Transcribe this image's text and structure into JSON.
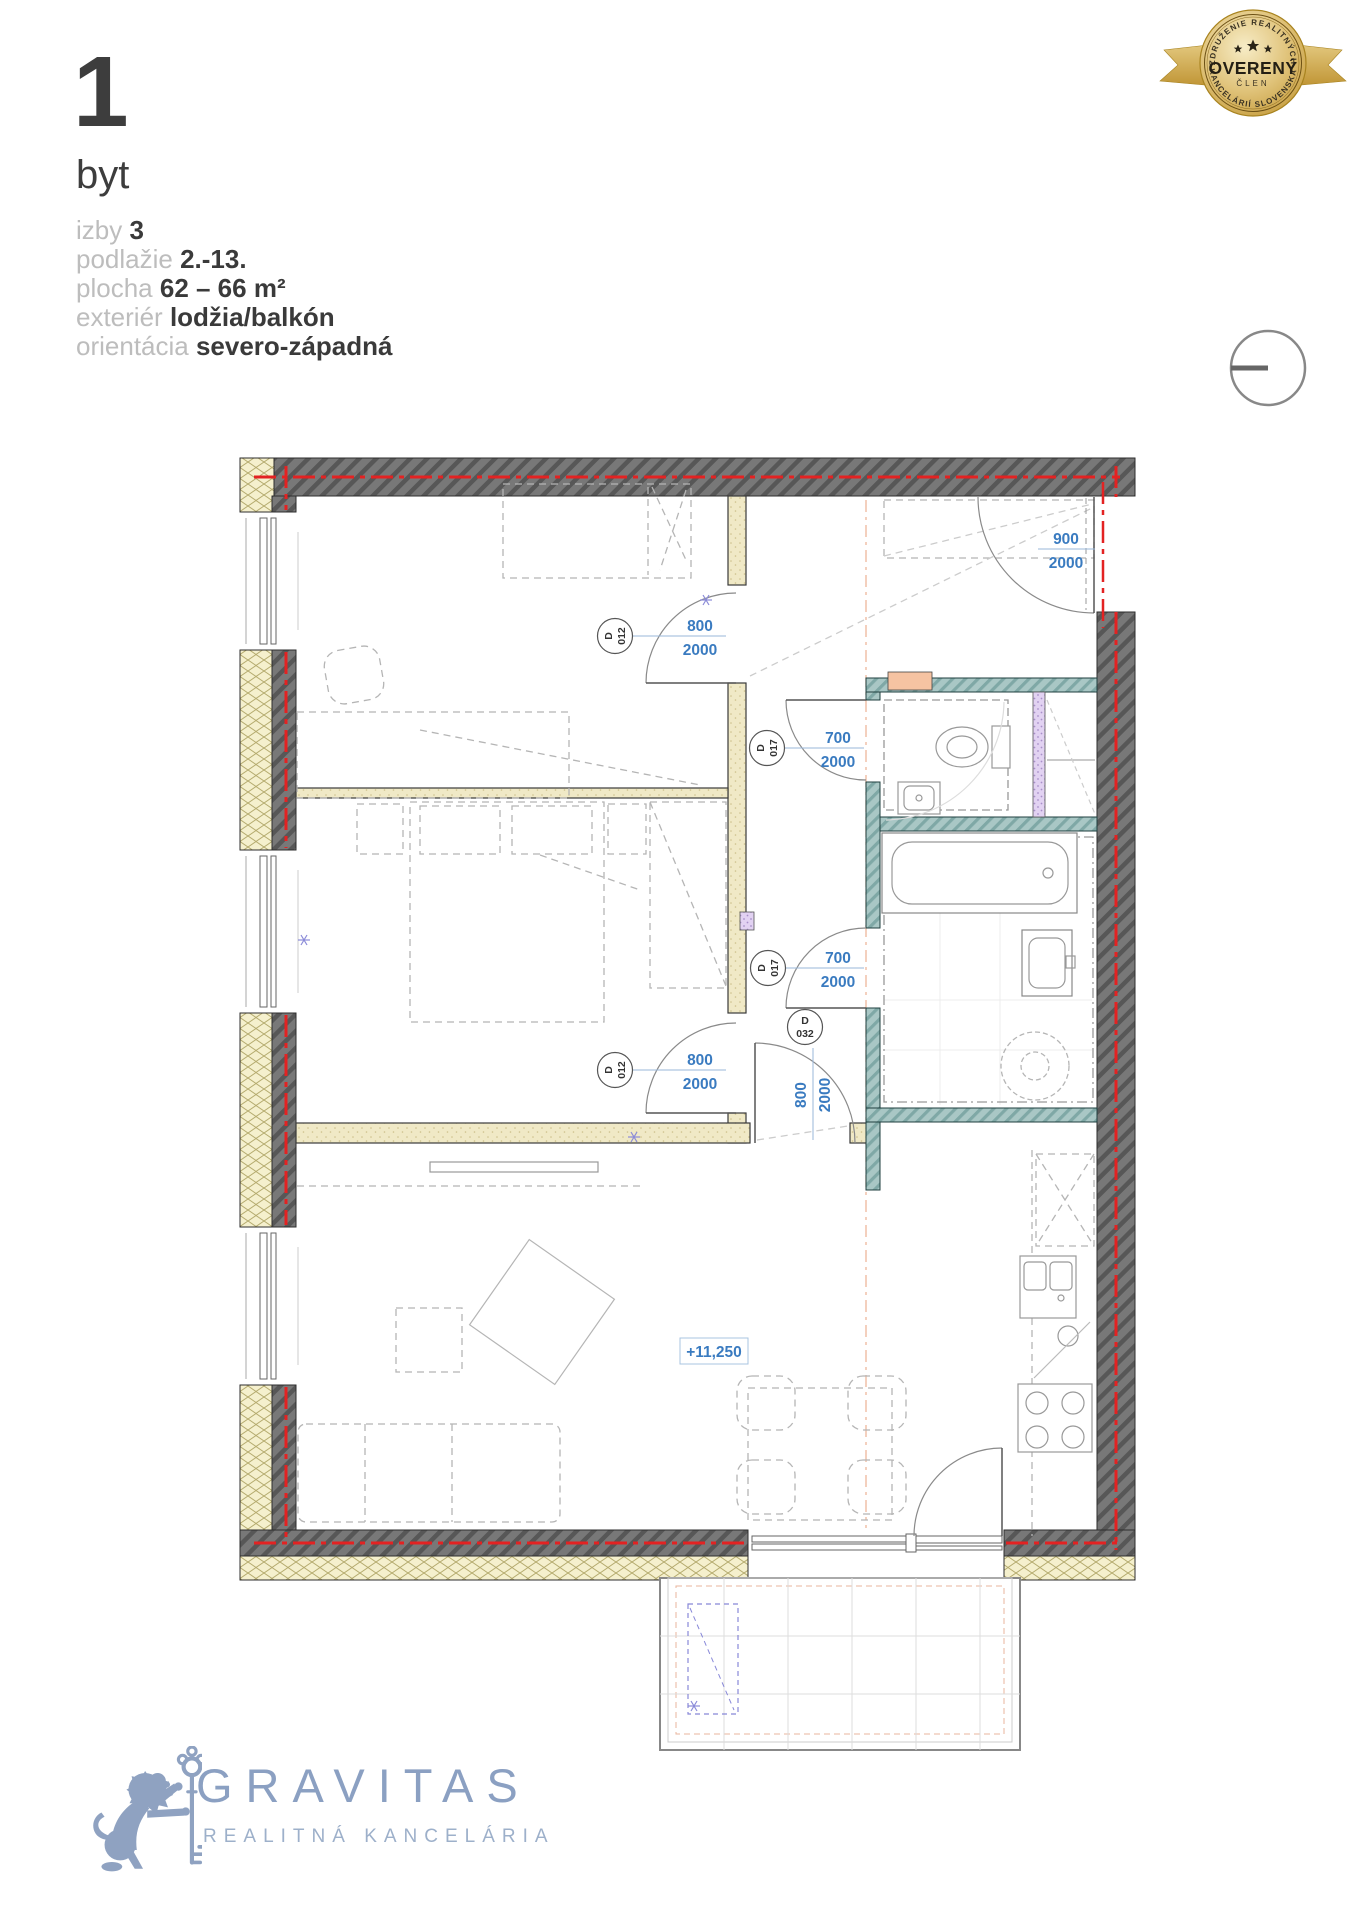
{
  "unit": {
    "number": "1",
    "type": "byt",
    "details": [
      {
        "label": "izby",
        "value": "3"
      },
      {
        "label": "podlažie",
        "value": "2.-13."
      },
      {
        "label": "plocha",
        "value": "62 – 66 m²"
      },
      {
        "label": "exteriér",
        "value": "lodžia/balkón"
      },
      {
        "label": "orientácia",
        "value": "severo-západná"
      }
    ]
  },
  "badge": {
    "top_arc": "ZDRUŽENIE REALITNÝCH",
    "title": "OVERENÝ",
    "member": "ČLEN",
    "bottom_arc": "KANCELÁRIÍ SLOVENSKA"
  },
  "floorplan": {
    "level_label": "+11,250",
    "door_labels": [
      {
        "code": "D",
        "num": "012",
        "w": "800",
        "h": "2000"
      },
      {
        "code": "D",
        "num": "012",
        "w": "800",
        "h": "2000"
      },
      {
        "code": "D",
        "num": "017",
        "w": "700",
        "h": "2000"
      },
      {
        "code": "D",
        "num": "017",
        "w": "700",
        "h": "2000"
      },
      {
        "code": "D",
        "num": "032",
        "w": "800",
        "h": "2000"
      },
      {
        "w": "900",
        "h": "2000"
      }
    ],
    "colors": {
      "exterior_wall": "#6f6f6f",
      "insulation": "#f5f0cd",
      "partition": "#f0e9c6",
      "wet_wall": "#a9c7c5",
      "shaft_lavender": "#e2d2f2",
      "salmon_block": "#f6c3a2",
      "centerline_red": "#e32222",
      "dimension_blue": "#3a7bc0"
    }
  },
  "brand": {
    "name": "GRAVITAS",
    "tagline": "REALITNÁ KANCELÁRIA",
    "color": "#8ba0c2"
  }
}
